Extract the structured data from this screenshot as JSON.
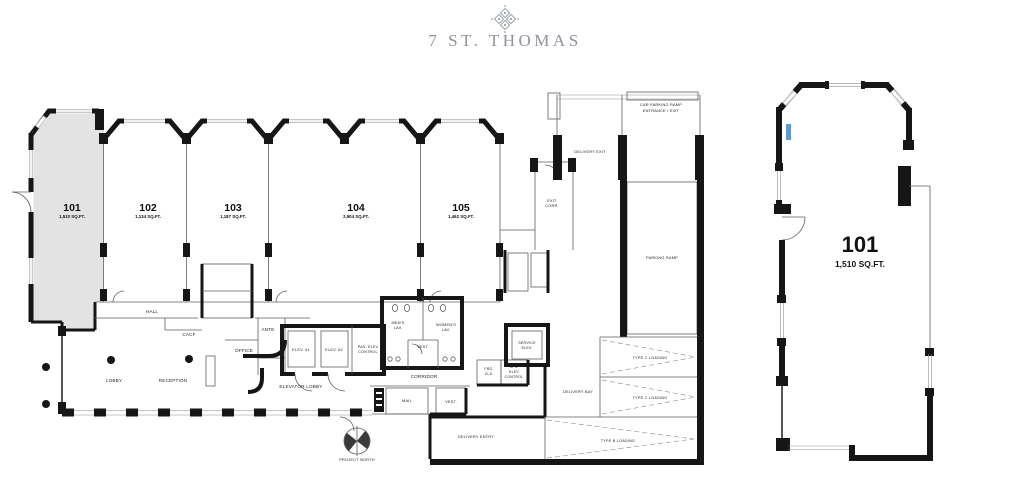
{
  "header": {
    "brand": "7 ST. THOMAS",
    "logo": "quatrefoil-diamond-ornament"
  },
  "main_plan": {
    "units": [
      {
        "number": "101",
        "area": "1,510 SQ.FT.",
        "highlighted": true
      },
      {
        "number": "102",
        "area": "1,134 SQ.FT.",
        "highlighted": false
      },
      {
        "number": "103",
        "area": "1,187 SQ.FT.",
        "highlighted": false
      },
      {
        "number": "104",
        "area": "2,904 SQ.FT.",
        "highlighted": false
      },
      {
        "number": "105",
        "area": "1,462 SQ.FT.",
        "highlighted": false
      }
    ],
    "labels": {
      "hall": "HALL",
      "cacf": "CACF",
      "office": "OFFICE",
      "ante": "ANTE",
      "lobby": "LOBBY",
      "reception": "RECEPTION",
      "elevator_lobby": "ELEVATOR LOBBY",
      "elev1": "ELEV. #1",
      "elev2": "ELEV. #2",
      "pas_elev_line1": "PAS. ELEV",
      "pas_elev_line2": "CONTROL",
      "mens_line1": "MEN'S",
      "mens_line2": "LAV.",
      "womens_line1": "WOMEN'S",
      "womens_line2": "LAV.",
      "vest_lav": "VEST.",
      "vest_mail": "VEST.",
      "corridor": "CORRIDOR",
      "mail": "MAIL",
      "frg_line1": "FRG.",
      "frg_line2": "CLS.",
      "spk_line1": "SPK.",
      "spk_line2": "ELEV",
      "spk_line3": "CONTROL",
      "service_elev_line1": "SERVICE",
      "service_elev_line2": "ELEV.",
      "exit_corr_line1": "EXIT",
      "exit_corr_line2": "CORR.",
      "delivery_exit": "DELIVERY EXIT",
      "car_ramp_line1": "CAR PARKING RAMP",
      "car_ramp_line2": "ENTRANCE / EXIT",
      "parking_ramp": "PARKING RAMP",
      "delivery_bay": "DELIVERY BAY",
      "type_c_loading_1": "TYPE C LOADING",
      "type_c_loading_2": "TYPE C LOADING",
      "type_b_loading": "TYPE B LOADING",
      "delivery_entry": "DELIVERY ENTRY",
      "project_north": "PROJECT NORTH"
    }
  },
  "detail_plan": {
    "number": "101",
    "area": "1,510 SQ.FT."
  },
  "colors": {
    "wall": "#161616",
    "unit_highlight_fill": "#e3e3e3",
    "brand_text": "#8d929c",
    "label_text": "#1d1d1d",
    "accent_blue": "#5b9bd5"
  }
}
